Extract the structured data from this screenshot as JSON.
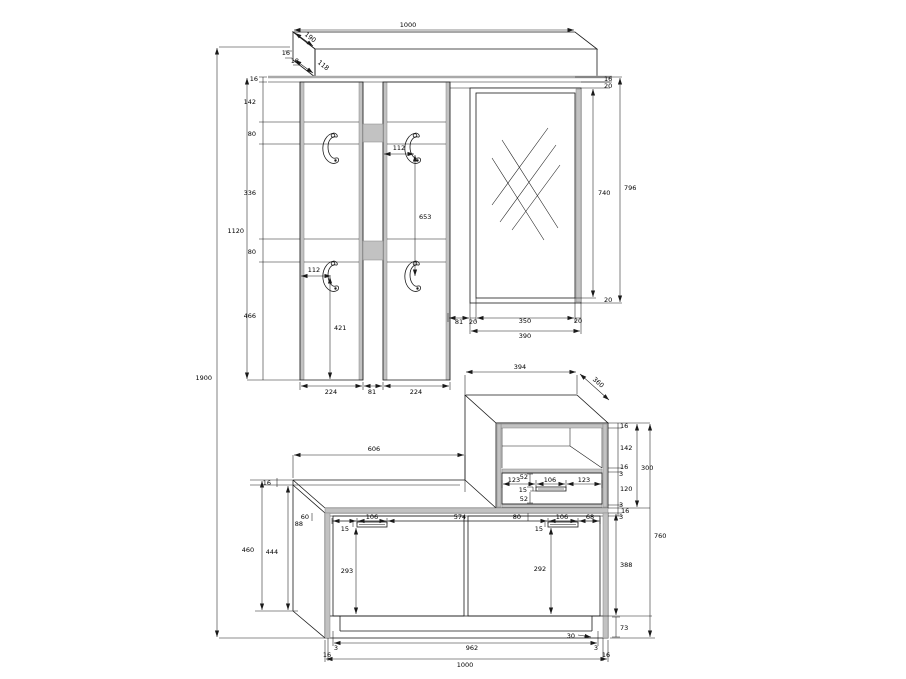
{
  "drawing": {
    "shelf": {
      "w1000": "1000",
      "d190": "190",
      "t16": "16",
      "t18": "18",
      "t118": "118"
    },
    "left": {
      "v16": "16",
      "v142": "142",
      "v80a": "80",
      "v336": "336",
      "v80b": "80",
      "v466": "466",
      "v1120": "1120",
      "v1900": "1900"
    },
    "panels": {
      "h112a": "112",
      "v653": "653",
      "h112b": "112",
      "v421": "421",
      "w224a": "224",
      "w81": "81",
      "w224b": "224"
    },
    "mirror": {
      "r16": "16",
      "r20a": "20",
      "r740": "740",
      "r796": "796",
      "r20b": "20",
      "mb81": "81",
      "mb20a": "20",
      "mb350": "350",
      "mb20b": "20",
      "mb390": "390"
    },
    "cabinet": {
      "w394": "394",
      "d360": "360",
      "r16a": "16",
      "r142": "142",
      "r16b": "16",
      "r3a": "3",
      "r120": "120",
      "r300": "300",
      "g3a": "3",
      "g16": "16",
      "g3b": "3",
      "i52a": "52",
      "i123a": "123",
      "i106": "106",
      "i123b": "123",
      "i15": "15",
      "i52b": "52"
    },
    "bench": {
      "w606": "606",
      "t16": "16",
      "d60": "60",
      "d88": "88",
      "d106a": "106",
      "d15a": "15",
      "d574": "574",
      "d80": "80",
      "d106b": "106",
      "d68": "68",
      "d15b": "15",
      "v293": "293",
      "v292": "292",
      "v388": "388",
      "v73": "73",
      "o30": "30",
      "v460": "460",
      "v444": "444",
      "b962": "962",
      "b3a": "3",
      "b16a": "16",
      "b3b": "3",
      "b16b": "16",
      "b1000": "1000",
      "r760": "760"
    }
  }
}
